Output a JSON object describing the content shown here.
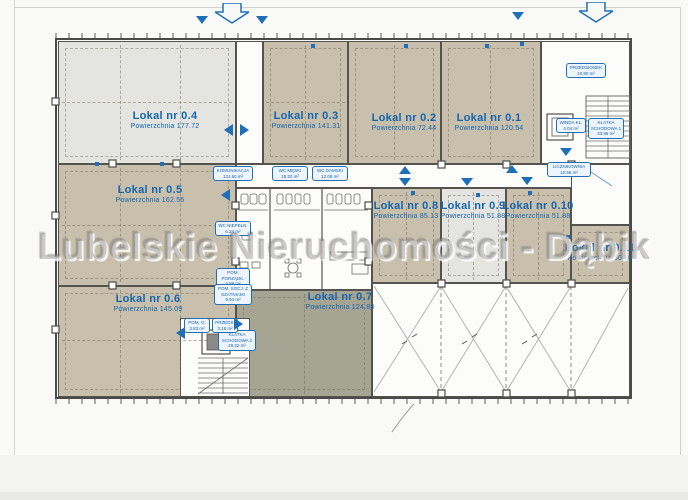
{
  "watermark": "Lubelskie Nieruchomości - Dąbik",
  "area_word": "Powierzchnia",
  "units": [
    {
      "name": "Lokal nr 0.4",
      "area_line": "Powierzchnia 177.72"
    },
    {
      "name": "Lokal nr 0.3",
      "area_line": "Powierzchnia 141.31"
    },
    {
      "name": "Lokal nr 0.2",
      "area_line": "Powierzchnia 72.44"
    },
    {
      "name": "Lokal nr 0.1",
      "area_line": "Powierzchnia 120.54"
    },
    {
      "name": "Lokal nr 0.5",
      "area_line": "Powierzchnia 162.55"
    },
    {
      "name": "Lokal nr 0.6",
      "area_line": "Powierzchnia 145.09"
    },
    {
      "name": "Lokal nr 0.7",
      "area_line": "Powierzchnia 124.83"
    },
    {
      "name": "Lokal nr 0.8",
      "area_line": "Powierzchnia 85.13"
    },
    {
      "name": "Lokal nr 0.9",
      "area_line": "Powierzchnia 51.88"
    },
    {
      "name": "Lokal nr 0.10",
      "area_line": "Powierzchnia 51.88"
    },
    {
      "name": "Lokal nr 0.11",
      "area_line": "Powierzchnia 50.10"
    }
  ],
  "service": {
    "komunikacja": {
      "name": "KOMUNIKACJA",
      "area": "131.60 m²"
    },
    "wc_meski": {
      "name": "WC MĘSKI",
      "area": "18.20 m²"
    },
    "wc_damski": {
      "name": "WC DAMSKI",
      "area": "12.08 m²"
    },
    "wc_niepeln": {
      "name": "WC NIEPEŁN.",
      "area": "6.24 m²"
    },
    "pom_porz": {
      "name": "POM. PORZĄDK.",
      "area": "4.88 m²"
    },
    "pom_socj": {
      "name": "POM. SOCJ. Z SZATNIAMI",
      "area": "9.94 m²"
    },
    "przedsionek": {
      "name": "PRZEDSIONEK",
      "area": "10.80 m²"
    },
    "winda": {
      "name": "WINDA KL.",
      "area": "4.04 m²"
    },
    "klatka1": {
      "name": "KLATKA SCHODOWA 1",
      "area": "33.86 m²"
    },
    "licznikownia": {
      "name": "LICZNIKOWNIA",
      "area": "10.55 m²"
    },
    "klatka2": {
      "name": "KLATKA SCHODOWA 2",
      "area": "28.22 m²"
    },
    "pom_g": {
      "name": "POM. G.",
      "area": "3.83 m²"
    },
    "przeds": {
      "name": "PRZEDS.",
      "area": "3.18 m²"
    }
  }
}
